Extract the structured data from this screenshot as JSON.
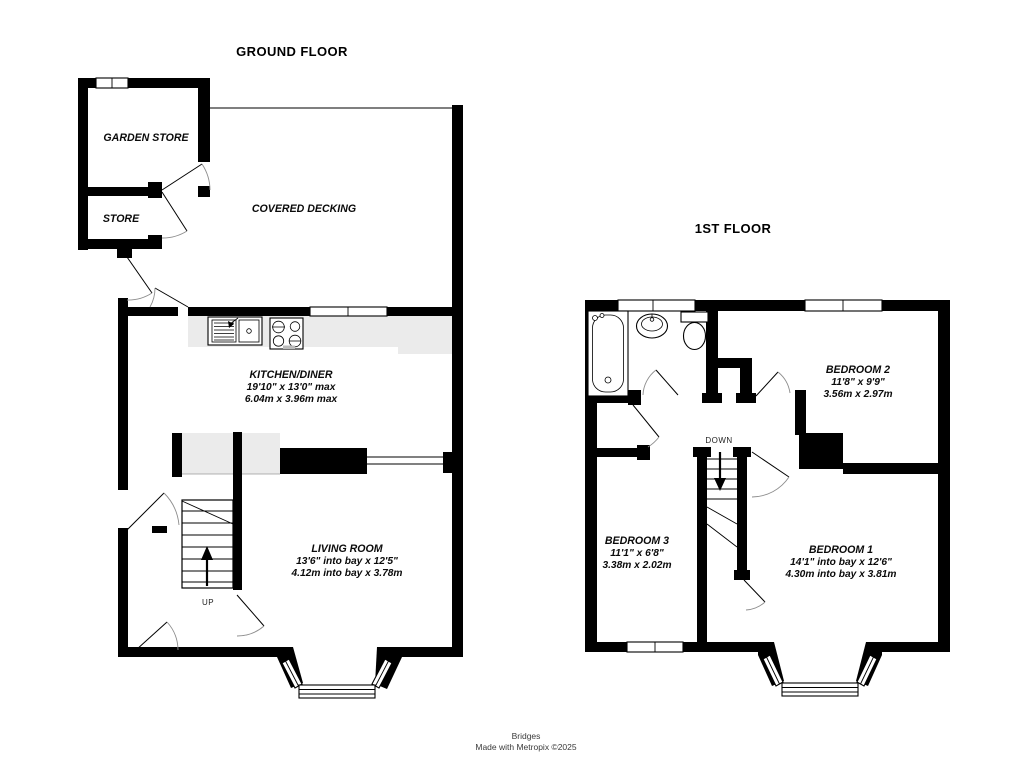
{
  "ground_floor": {
    "title": "GROUND FLOOR",
    "garden_store": {
      "name": "GARDEN STORE"
    },
    "store": {
      "name": "STORE"
    },
    "covered_decking": {
      "name": "COVERED DECKING"
    },
    "kitchen": {
      "name": "KITCHEN/DINER",
      "imperial": "19'10\"  x 13'0\" max",
      "metric": "6.04m  x 3.96m max"
    },
    "living_room": {
      "name": "LIVING ROOM",
      "imperial": "13'6\" into bay x 12'5\"",
      "metric": "4.12m into bay x 3.78m"
    },
    "stairs_label": "UP"
  },
  "first_floor": {
    "title": "1ST FLOOR",
    "bedroom1": {
      "name": "BEDROOM 1",
      "imperial": "14'1\" into bay x 12'6\"",
      "metric": "4.30m into bay x 3.81m"
    },
    "bedroom2": {
      "name": "BEDROOM 2",
      "imperial": "11'8\"  x 9'9\"",
      "metric": "3.56m  x 2.97m"
    },
    "bedroom3": {
      "name": "BEDROOM 3",
      "imperial": "11'1\"  x 6'8\"",
      "metric": "3.38m  x 2.02m"
    },
    "stairs_label": "DOWN"
  },
  "footer": {
    "brand": "Bridges",
    "credit": "Made with Metropix ©2025"
  },
  "colors": {
    "wall": "#000000",
    "counter_fill": "#ebebeb",
    "text": "#0a0a0a",
    "footer_text": "#3a3a3a"
  }
}
